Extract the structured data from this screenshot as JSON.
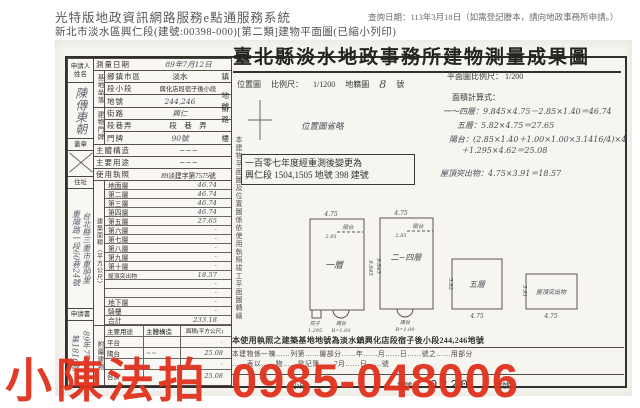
{
  "colors": {
    "watermark_red": "#e13420",
    "paper": "#f6f5f0",
    "ink": "#2e2c28"
  },
  "header": {
    "system_title": "光特版地政資訊網路服務e點通服務系統",
    "query_date": "查詢日期：113年3月18日（如需登記謄本，請向地政事務所申請。）",
    "subtitle": "新北市淡水區興仁段(建號:00398-000)[第二類]建物平面圖(已縮小列印)"
  },
  "document": {
    "title": "臺北縣淡水地政事務所建物測量成果圖",
    "location_map": {
      "label": "位置圖",
      "scale_label": "比例尺：",
      "scale": "1/1200",
      "map_label": "地籍圖",
      "sheet": "8",
      "unit": "號",
      "omitted": "位置圖省略"
    },
    "plan_scale": {
      "label": "平面圖比例尺：",
      "scale": "1/200"
    },
    "formula_label": "面積計算式：",
    "formula_lines": [
      "一～四層：9.845×4.75－2.85×1.40＝46.74",
      "五層：5.82×4.75＝27.65",
      "陽台：(2.85×1.40＋1.00×1.00×3.1416/4)×4",
      "＋1.295×4.62＝25.08"
    ],
    "roof_formula": "屋頂突出物：4.75×3.91＝18.57",
    "remeasure_note_line1": "一百零七年度經重測後變更為",
    "remeasure_note_line2": "興仁段 1504,1505 地號 398 建號",
    "side_caption": "本建物平面圖及位置圖係依使用執照竣工平面圖轉繪"
  },
  "form": {
    "applicant": {
      "label": "申請人姓名",
      "signature": "陳傳東朝",
      "seal_label": "蓋章"
    },
    "address": {
      "label": "住址",
      "line1": "台北縣三重市重明里",
      "line2": "重陽路一段60巷24號"
    },
    "application": {
      "label": "申請書",
      "line1": "89年7月6日",
      "line2": "第1816號"
    },
    "survey_date": {
      "label": "測量日期",
      "value": "89年7月12日"
    },
    "site": {
      "label": "基地坐落",
      "rows": [
        {
          "label": "鄉鎮市區",
          "value": "淡水",
          "unit": "鎮"
        },
        {
          "label": "段小段",
          "value": "興化店段宿子後小段",
          "unit": ""
        },
        {
          "label": "地號",
          "value": "244,246",
          "unit": "地號"
        }
      ]
    },
    "door": {
      "label": "建物門牌",
      "rows": [
        {
          "label": "街路",
          "value": "興仁",
          "unit": "街路"
        },
        {
          "label": "段巷弄",
          "value": "段　巷　弄",
          "unit": ""
        },
        {
          "label": "門牌",
          "value": "90號",
          "unit": "樓"
        }
      ]
    },
    "structure": {
      "label": "主體構造",
      "value": "~~~"
    },
    "usage": {
      "label": "主要用途",
      "value": "~~~"
    },
    "permit": {
      "label": "使用執照",
      "value": "89淡建字第7575號"
    },
    "floors": {
      "label": "建築面積（平方公尺）",
      "rows": [
        {
          "label": "地面層",
          "value": "46.74"
        },
        {
          "label": "第二層",
          "value": "46.74"
        },
        {
          "label": "第三層",
          "value": "46.74"
        },
        {
          "label": "第四層",
          "value": "46.74"
        },
        {
          "label": "第五層",
          "value": "27.65"
        },
        {
          "label": "第六層",
          "value": "·"
        },
        {
          "label": "第七層",
          "value": "·"
        },
        {
          "label": "第八層",
          "value": "·"
        },
        {
          "label": "第九層",
          "value": "·"
        },
        {
          "label": "第十層",
          "value": "·"
        },
        {
          "label": "屋頂突出物",
          "value": "18.57"
        },
        {
          "label": "",
          "value": "·"
        },
        {
          "label": "",
          "value": "·"
        },
        {
          "label": "地下層",
          "value": "·"
        },
        {
          "label": "騎樓",
          "value": "·"
        },
        {
          "label": "合計",
          "value": "233.18"
        }
      ]
    },
    "annex": {
      "label": "附屬建物",
      "header": {
        "use": "主要用途",
        "structure": "主體構造",
        "area": "面積(平方公尺)"
      },
      "rows": [
        {
          "use": "平台",
          "structure": "",
          "area": "·"
        },
        {
          "use": "陽台",
          "structure": "~~",
          "area": "25.08"
        },
        {
          "use": "",
          "structure": "",
          "area": "·"
        }
      ],
      "total": {
        "label": "合計",
        "value": "25.08"
      }
    }
  },
  "plans": {
    "p1": {
      "label": "一層",
      "top_dim": "4.75",
      "side_dim": "9.845",
      "balcony": "陽台",
      "balcony_dim": "2.85",
      "yard": "院子",
      "yard_dim": "1.295",
      "arc": "陽台",
      "arc_dim": "R=1.00"
    },
    "p2": {
      "label": "二~四層",
      "top_dim": "4.75",
      "side_dim": "9.845",
      "balcony": "陽台",
      "balcony_dim": "2.85",
      "arc": "陽台",
      "arc_dim": "R=1.00"
    },
    "p3": {
      "label": "五層",
      "bottom_dim": "4.75",
      "side_dim": "5.82"
    },
    "p4": {
      "label": "屋頂突出物",
      "bottom_dim": "4.75",
      "side_dim": "3.91"
    }
  },
  "footer": {
    "site_note": "本使用執照之建築基地地號為淡水鎮興化店段宿子後小段244,246地號",
    "line1": "本建物係一棟……列第……層部分……年……月……日……號之……用部分",
    "line2": "……表以……物……登記簿……7月……日……號",
    "seg_label": "小段",
    "lot_label": "地號",
    "stamp": "0220",
    "bldg_label": "建號"
  },
  "watermark": {
    "text": "小陳法拍",
    "phone": "0985-048006"
  }
}
